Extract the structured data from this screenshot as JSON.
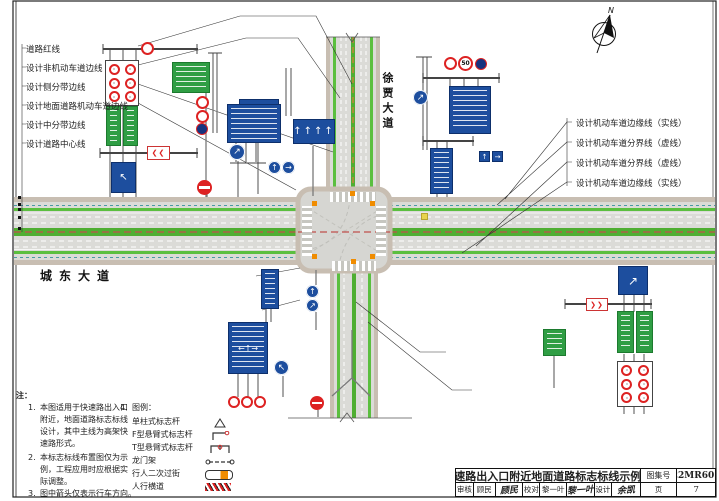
{
  "north": {
    "label": "N"
  },
  "roads": {
    "horizontal_name": "城东大道",
    "vertical_name": "徐贾大道"
  },
  "callouts": {
    "left": [
      "道路红线",
      "设计非机动车道边线",
      "设计侧分带边线",
      "设计地面道路机动车道边线",
      "设计中分带边线",
      "设计道路中心线"
    ],
    "right": [
      "设计机动车道边缘线（实线）",
      "设计机动车道分界线（虚线）",
      "设计机动车道分界线（虚线）",
      "设计机动车道边缘线（实线）"
    ]
  },
  "notes": {
    "heading": "注：",
    "items": [
      {
        "no": "1.",
        "lines": [
          "本图适用于快速路出入口",
          "附近，地面道路标志标线",
          "设计，其中主线为高架快",
          "速路形式。"
        ]
      },
      {
        "no": "2.",
        "lines": [
          "本标志标线布置图仅为示",
          "例，工程应用时应根据实",
          "际调整。"
        ]
      },
      {
        "no": "3.",
        "lines": [
          "图中箭头仅表示行车方向。"
        ]
      }
    ],
    "legend": {
      "no": "4.",
      "heading": "图例：",
      "items": [
        "单柱式标志杆",
        "F型悬臂式标志杆",
        "T型悬臂式标志杆",
        "龙门架",
        "行人二次过街",
        "人行横道"
      ]
    }
  },
  "titleblock": {
    "title": "快速路出入口附近地面道路标志标线示例图",
    "atlas_label": "图集号",
    "atlas_no": "22MR601",
    "review_label": "审核",
    "review_name": "顾民",
    "review_sig": "顾民",
    "check_label": "校对",
    "check_name": "黎一叶",
    "check_sig": "黎一叶",
    "design_label": "设计",
    "design_name": "余凯",
    "design_sig": "余凯",
    "page_label": "页",
    "page_no": "7"
  },
  "signs": {
    "speed_limit": "50",
    "chevrons_left": "❮❮",
    "chevrons_right": "❯❯",
    "arrow_up": "↑",
    "arrow_right": "→",
    "arrow_up_right": "↗",
    "arrow_up_left": "↖",
    "arrow_left_right": "←→",
    "lane_arrows": "↑↑↑↑",
    "multi_arrows": "←↑→"
  },
  "colors": {
    "sign_blue": "#1d4e9e",
    "sign_green": "#2f9e44",
    "prohibition_red": "#d22",
    "median_green": "#4fae32",
    "sidewalk_tan": "#c8beb2",
    "centerline_red": "#c0504d",
    "corner_orange": "#f08c00"
  }
}
